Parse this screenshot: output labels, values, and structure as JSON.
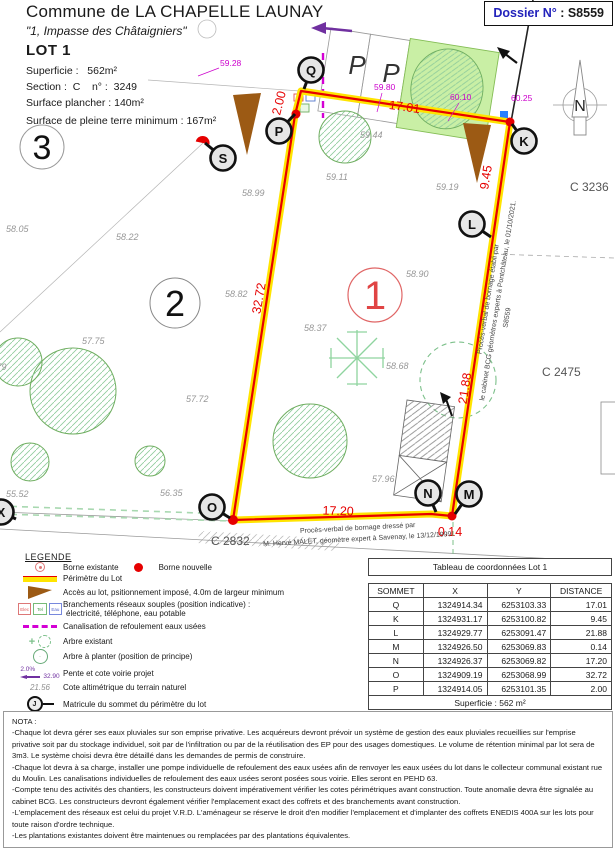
{
  "header": {
    "commune": "Commune de LA CHAPELLE LAUNAY",
    "address": "\"1, Impasse des Châtaigniers\"",
    "lot": "LOT 1",
    "superficie": "Superficie :   562m²",
    "section": "Section :  C    n° :  3249",
    "surface_plancher": "Surface plancher : 140m²",
    "pleine_terre": "Surface de pleine terre minimum : 167m²",
    "dossier_label": "Dossier N°",
    "dossier_value": " : S8559"
  },
  "plan": {
    "vertices": [
      "Q",
      "P",
      "S",
      "K",
      "L",
      "N",
      "M",
      "O",
      "X"
    ],
    "dims": {
      "pq": "2.00",
      "qk": "17.01",
      "kl": "9.45",
      "lm": "21.88",
      "mn": "0.14",
      "no": "17.20",
      "op": "32.72"
    },
    "project_levels": [
      "59.28",
      "59.80",
      "60.10",
      "60.25"
    ],
    "natural_levels": [
      "58.05",
      "58.22",
      "58.99",
      "58.82",
      "59.44",
      "59.11",
      "59.19",
      "58.90",
      "58.37",
      "58.68",
      "57.75",
      "57.72",
      "55.52",
      "56.35",
      "57.96",
      "55.79"
    ],
    "parcels": [
      "1",
      "2",
      "3"
    ],
    "cadastre": [
      "C 3236",
      "C 2475",
      "C 2832"
    ],
    "parking_label": "P",
    "north_label": "N",
    "pv_right": [
      "Procès-verbal de bornage établi par",
      "le cabinet BCG géomètres experts à Pontchâteau, le 01/10/2021.",
      "S8559"
    ],
    "pv_bottom": [
      "Procès-verbal de bornage dressé par",
      "M. Hervé MALET, géomètre expert à Savenay, le 13/12/1999."
    ]
  },
  "legend": {
    "title": "LEGENDE",
    "borne_existante": "Borne existante",
    "borne_nouvelle": "Borne nouvelle",
    "perimetre": "Périmètre du Lot",
    "acces": "Accès au lot, psitionnement imposé, 4.0m de largeur minimum",
    "branchements_1": "Branchements réseaux souples (position indicative) :",
    "branchements_2": "électricité, téléphone, eau potable",
    "box_elec": "Elec",
    "box_tel": "Tel",
    "box_eau": "Eau",
    "canalisation": "Canalisation de refoulement eaux usées",
    "arbre_existant": "Arbre existant",
    "arbre_planter": "Arbre à planter (position de principe)",
    "pente": "Pente et cote voirie projet",
    "pente_pct": "2.0%",
    "pente_val": "32.90",
    "cote_alti": "Cote altimétrique du terrain naturel",
    "cote_val": "21.56",
    "matricule": "Matricule du sommet du périmètre du lot",
    "matricule_letter": "J"
  },
  "table": {
    "title": "Tableau de coordonnées Lot 1",
    "headers": [
      "SOMMET",
      "X",
      "Y",
      "DISTANCE"
    ],
    "rows": [
      [
        "Q",
        "1324914.34",
        "6253103.33",
        "17.01"
      ],
      [
        "K",
        "1324931.17",
        "6253100.82",
        "9.45"
      ],
      [
        "L",
        "1324929.77",
        "6253091.47",
        "21.88"
      ],
      [
        "M",
        "1324926.50",
        "6253069.83",
        "0.14"
      ],
      [
        "N",
        "1324926.37",
        "6253069.82",
        "17.20"
      ],
      [
        "O",
        "1324909.19",
        "6253068.99",
        "32.72"
      ],
      [
        "P",
        "1324914.05",
        "6253101.35",
        "2.00"
      ]
    ],
    "footer": "Superficie : 562 m²",
    "note1": "Nivellement système NGF-IGN69 - Rattachement TERIA",
    "note2": "Coordonnées système L93-CC47  - Rattachement TERIA"
  },
  "nota": {
    "lines": [
      "NOTA :",
      "-Chaque lot devra gérer ses eaux pluviales sur son emprise privative. Les acquéreurs devront prévoir un système de gestion des eaux pluviales recueillies sur l'emprise privative soit par du stockage individuel, soit par de l'infiltration ou par de la réutilisation des EP pour des usages domestiques. Le volume de rétention minimal par lot sera de 3m3. Le système choisi devra être détaillé dans les demandes de permis de construire.",
      "-Chaque lot devra à sa charge, installer une pompe individuelle de refoulement des eaux usées afin de renvoyer les eaux usées du lot dans le collecteur communal existant rue du Moulin. Les canalisations individuelles de refoulement des eaux usées seront posées sous voirie. Elles seront en PEHD 63.",
      "-Compte tenu des activités des chantiers, les constructeurs doivent impérativement vérifier les cotes périmétriques avant construction. Toute anomalie devra être signalée au cabinet BCG. Les constructeurs devront également vérifier l'emplacement exact des coffrets et des branchements avant construction.",
      "-L'emplacement des réseaux est celui du projet V.R.D. L'aménageur se réserve le droit d'en modifier l'emplacement et d'implanter des coffrets ENEDIS 400A sur les lots pour toute raison d'ordre technique.",
      "-Les plantations existantes doivent être maintenues ou remplacées par des plantations équivalentes."
    ]
  },
  "colors": {
    "perimeter_red": "#e60000",
    "perimeter_yellow": "#ffe400",
    "sewer_magenta": "#d400d4",
    "access_brown": "#9c5a14",
    "tree_green": "#6fae60",
    "water_blue": "#2a7fff",
    "slope_purple": "#7030a0",
    "dossier_blue": "#2222bb"
  }
}
